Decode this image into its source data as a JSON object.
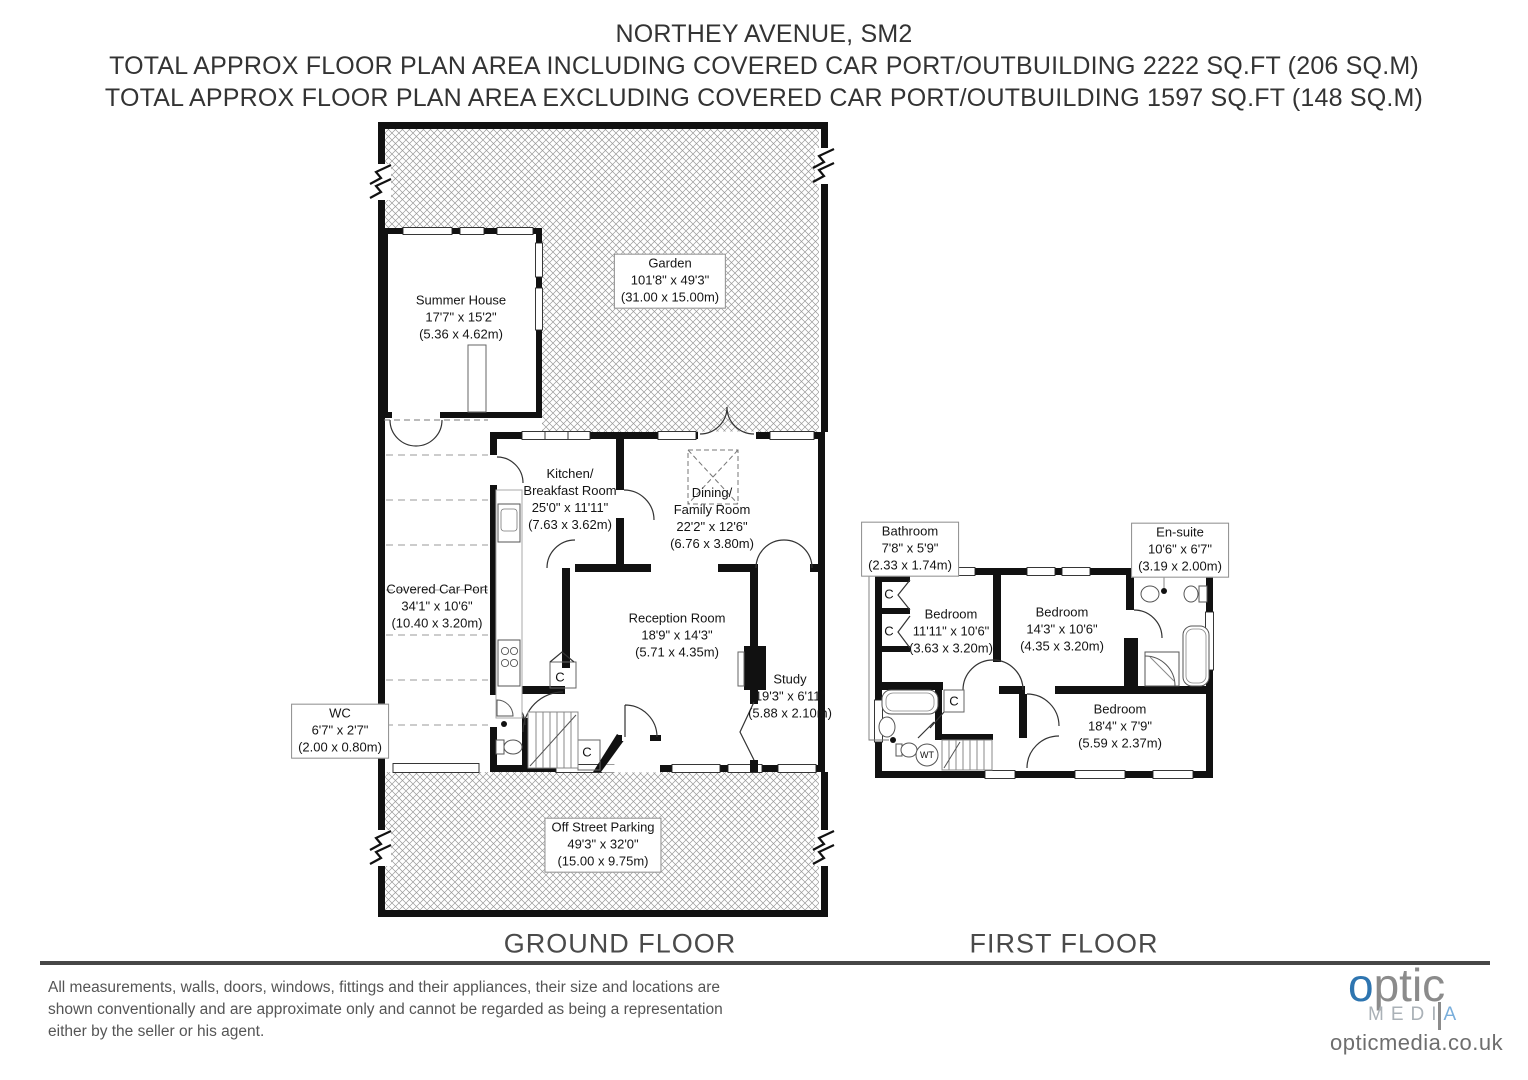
{
  "title": {
    "line1": "NORTHEY AVENUE, SM2",
    "line2": "TOTAL APPROX FLOOR PLAN AREA INCLUDING COVERED CAR PORT/OUTBUILDING 2222 SQ.FT (206 SQ.M)",
    "line3": "TOTAL APPROX FLOOR PLAN AREA EXCLUDING COVERED CAR PORT/OUTBUILDING 1597 SQ.FT (148 SQ.M)"
  },
  "ground_floor": {
    "label": "GROUND FLOOR",
    "rooms": [
      {
        "name": "Summer House",
        "dims": "17'7\" x 15'2\"",
        "metric": "(5.36 x 4.62m)"
      },
      {
        "name": "Garden",
        "dims": "101'8\" x 49'3\"",
        "metric": "(31.00 x 15.00m)"
      },
      {
        "name": "Kitchen/\nBreakfast Room",
        "dims": "25'0\" x 11'11\"",
        "metric": "(7.63 x 3.62m)"
      },
      {
        "name": "Dining/\nFamily Room",
        "dims": "22'2\" x 12'6\"",
        "metric": "(6.76 x 3.80m)"
      },
      {
        "name": "Covered Car Port",
        "dims": "34'1\" x 10'6\"",
        "metric": "(10.40 x 3.20m)"
      },
      {
        "name": "Reception Room",
        "dims": "18'9\" x 14'3\"",
        "metric": "(5.71 x 4.35m)"
      },
      {
        "name": "Study",
        "dims": "19'3\" x 6'11\"",
        "metric": "(5.88 x 2.10m)"
      },
      {
        "name": "WC",
        "dims": "6'7\" x 2'7\"",
        "metric": "(2.00 x 0.80m)"
      },
      {
        "name": "Off Street Parking",
        "dims": "49'3\" x 32'0\"",
        "metric": "(15.00 x 9.75m)"
      }
    ]
  },
  "first_floor": {
    "label": "FIRST FLOOR",
    "rooms": [
      {
        "name": "Bathroom",
        "dims": "7'8\" x 5'9\"",
        "metric": "(2.33 x 1.74m)"
      },
      {
        "name": "En-suite",
        "dims": "10'6\" x 6'7\"",
        "metric": "(3.19 x 2.00m)"
      },
      {
        "name": "Bedroom",
        "dims": "11'11\" x 10'6\"",
        "metric": "(3.63 x 3.20m)"
      },
      {
        "name": "Bedroom",
        "dims": "14'3\" x 10'6\"",
        "metric": "(4.35 x 3.20m)"
      },
      {
        "name": "Bedroom",
        "dims": "18'4\" x 7'9\"",
        "metric": "(5.59 x 2.37m)"
      }
    ]
  },
  "symbols": {
    "closet": "C",
    "water_tank": "WT"
  },
  "footer": {
    "disclaimer": "All measurements, walls, doors, windows, fittings and their appliances, their size and locations are shown conventionally and are approximate only and cannot be regarded as being a representation either by the seller or his agent.",
    "logo": {
      "optic_o": "o",
      "optic_rest": "ptic",
      "media_part1": "MEDI",
      "media_part2": "A",
      "website": "opticmedia.co.uk"
    },
    "colors": {
      "logo_blue": "#2e75b0",
      "logo_gray": "#8b8b8b"
    }
  }
}
